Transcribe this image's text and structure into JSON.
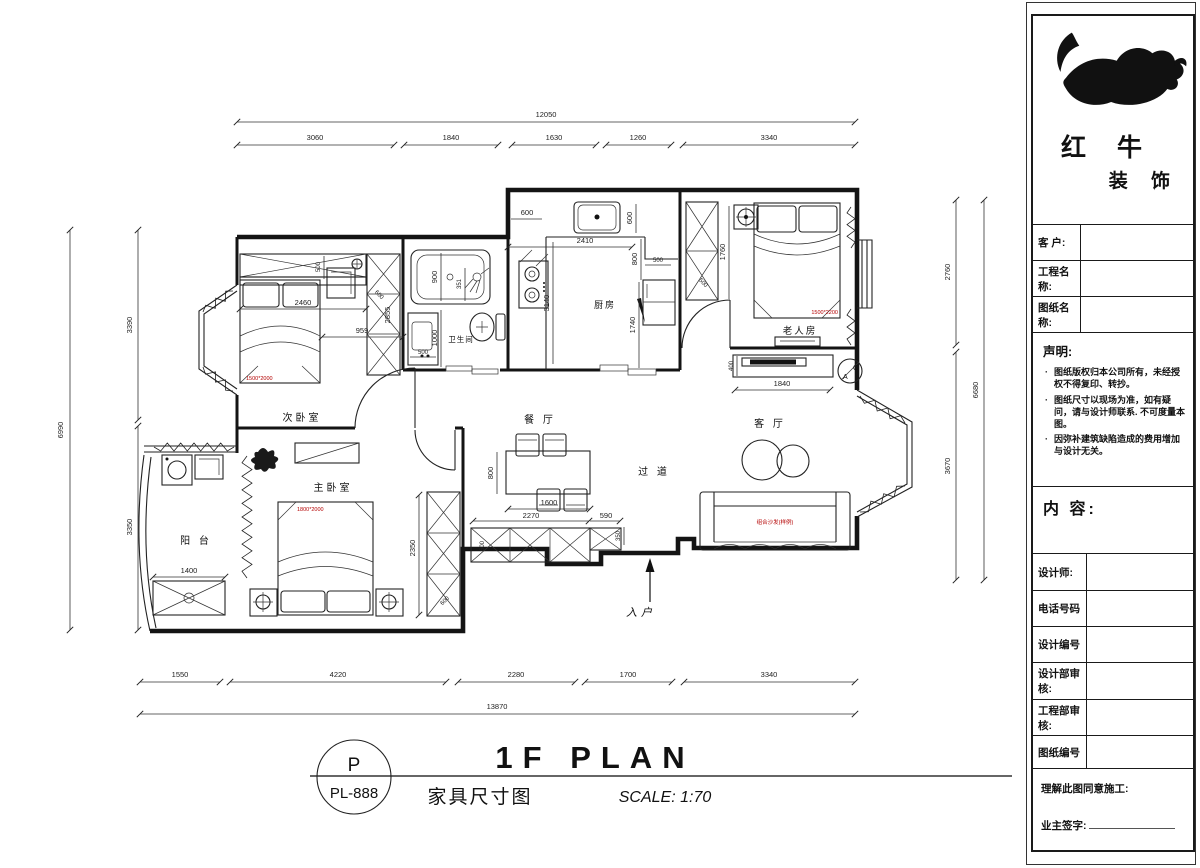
{
  "colors": {
    "annotation_red": "#b40000",
    "line": "#1a1a1a"
  },
  "sidebar": {
    "brand_top": "红 牛",
    "brand_bottom": "装 饰",
    "rows": [
      {
        "label": "客  户:"
      },
      {
        "label": "工程名称:"
      },
      {
        "label": "图纸名称:"
      }
    ],
    "statement_title": "声明:",
    "statement_items": [
      "图纸版权归本公司所有，未经授权不得复印、转抄。",
      "图纸尺寸以现场为准，如有疑问，请与设计师联系. 不可度量本图。",
      "因弥补建筑缺陷造成的费用增加与设计无关。"
    ],
    "content_title": "内 容:",
    "detail_rows": [
      {
        "label": "设计师:"
      },
      {
        "label": "电话号码"
      },
      {
        "label": "设计编号"
      },
      {
        "label": "设计部审核:"
      },
      {
        "label": "工程部审核:"
      },
      {
        "label": "图纸编号"
      }
    ],
    "approval_line1": "理解此图同意施工:",
    "approval_line2": "业主签字:"
  },
  "titleblock": {
    "stamp_letter": "P",
    "stamp_code": "PL-888",
    "title": "1F PLAN",
    "subtitle": "家具尺寸图",
    "scale": "SCALE: 1:70"
  },
  "plan": {
    "rooms": {
      "secondary": "次卧室",
      "master": "主卧室",
      "balcony": "阳 台",
      "bath": "卫生间",
      "kitchen": "厨房",
      "elder": "老人房",
      "dining": "餐 厅",
      "corridor": "过 道",
      "living": "客 厅",
      "entry": "入户"
    },
    "dims": {
      "top_total": "12050",
      "top": [
        "3060",
        "1840",
        "1630",
        "1260",
        "3340"
      ],
      "bottom": [
        "1550",
        "4220",
        "2280",
        "1700",
        "3340"
      ],
      "bottom_total": "13870",
      "left_total": "6990",
      "left": [
        "3390",
        "3350"
      ],
      "right": [
        "2760",
        "3670"
      ],
      "right_total": "6680",
      "inner": {
        "k600a": "600",
        "k600b": "600",
        "k2410": "2410",
        "k800": "800",
        "k500": "500",
        "k3140": "3140",
        "k1740": "1740",
        "e1760": "1760",
        "e500": "500",
        "e400": "400",
        "e1840": "1840",
        "c500": "500",
        "c2460": "2460",
        "c959": "959",
        "c2855": "2855",
        "c600": "600",
        "b900": "900",
        "b351": "351",
        "b1000": "1000",
        "b500": "500",
        "dn800": "800",
        "dn1600": "1600",
        "dn2270": "2270",
        "dn590": "590",
        "dn600": "600",
        "dn350": "350",
        "m2350": "2350",
        "m600": "600",
        "m1400": "1400"
      }
    },
    "labels": {
      "bed_secondary": "1500*2000",
      "bed_elder": "1500*2200",
      "bed_master": "1800*2000",
      "sofa": "组合沙发(样例)",
      "ac_top": "C",
      "ac_bottom": "A"
    }
  }
}
